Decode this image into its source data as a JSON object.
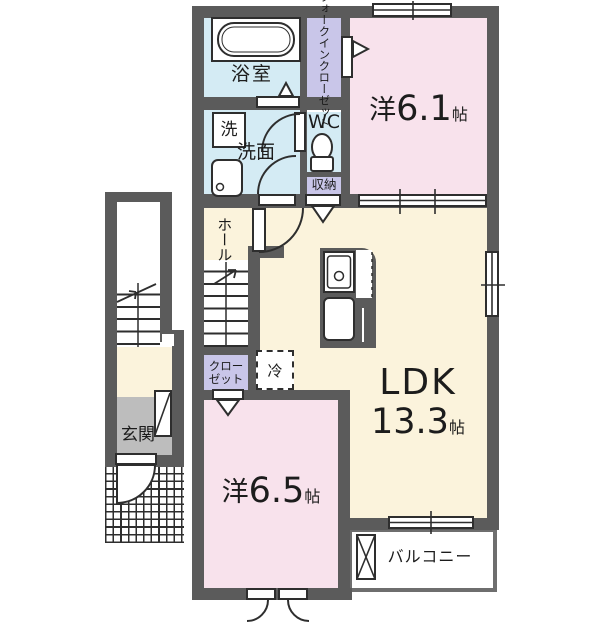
{
  "colors": {
    "wall": "#5b5b5b",
    "pink": "#f8e2ec",
    "cream": "#fbf3dc",
    "blue": "#d4ebf4",
    "purple": "#c9c6e9",
    "gray": "#bdbdbd",
    "line": "#2e2e2e",
    "balcony": "#6e6e6e"
  },
  "rooms": {
    "bath": {
      "label": "浴室"
    },
    "washer": {
      "label": "洗"
    },
    "washroom": {
      "label": "洗面"
    },
    "wic": {
      "line1": "ウォークイン",
      "line2": "クローゼット"
    },
    "wc": {
      "label": "WC"
    },
    "storage": {
      "label": "収納"
    },
    "hall": {
      "label": "ホール"
    },
    "closet": {
      "line1": "クロー",
      "line2": "ゼット"
    },
    "fridge": {
      "label": "冷"
    },
    "western61": {
      "prefix": "洋",
      "size": "6.1",
      "unit": "帖"
    },
    "western65": {
      "prefix": "洋",
      "size": "6.5",
      "unit": "帖"
    },
    "ldk": {
      "name": "LDK",
      "size": "13.3",
      "unit": "帖"
    },
    "entrance": {
      "label": "玄関"
    },
    "balcony": {
      "label": "バルコニー"
    }
  }
}
